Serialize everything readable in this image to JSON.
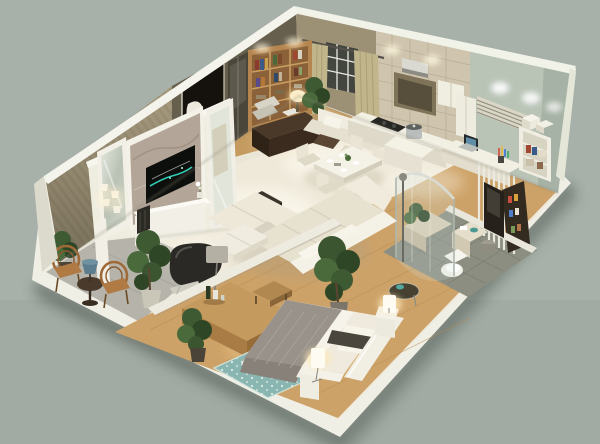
{
  "meta": {
    "type": "3d-render",
    "view": "isometric cutaway floor plan, viewed from above",
    "subject": "one-bedroom apartment interior with open living space"
  },
  "palette": {
    "background": "#a7b1a9",
    "shell_white": "#f0efe5",
    "tile_floor": "#efe9da",
    "wood_floor_bedroom": "#cda268",
    "wood_floor_study": "#c49a5f",
    "balcony_tile": "#b5b3aa",
    "bath_tile": "#8b8e80",
    "wall_stripe": "#a89c80",
    "wall_olive": "#665f4e",
    "wall_tan": "#9c9075",
    "wall_green": "#b9c3b6",
    "stone_wall": "#cfc5ae",
    "marble": "#b3a698",
    "partition_white": "#efece0",
    "sofa": "#e7e1d0",
    "blanket": "#98928a",
    "rug": "#8ab6b1",
    "curtain": "#c1b58b",
    "bookshelf_wood": "#b4854f",
    "desk_wood": "#4a3828",
    "tv_glow": "#35e0c5",
    "plant_green": "#3e5a32",
    "rattan": "#b07a45",
    "lamp_warm": "#fdf6e2"
  },
  "scene": {
    "rooms": [
      {
        "name": "living-room",
        "floor": "cream tile",
        "items": [
          "marble tv feature wall",
          "flatscreen tv",
          "white media console",
          "speaker",
          "framed mirror with sconce lamps",
          "tall dressing mirror",
          "l-shaped cream sectional sofa",
          "dark coffee table",
          "white ottoman table",
          "charcoal lounge chair with footrest",
          "grey floor lamp",
          "potted ficus tree"
        ]
      },
      {
        "name": "balcony",
        "floor": "grey marble tile",
        "items": [
          "two rattan armchairs",
          "round side table",
          "blue table lamp",
          "potted plant"
        ]
      },
      {
        "name": "study",
        "floor": "oak wood",
        "items": [
          "entry doorway",
          "striped wallpaper wall",
          "glass display cabinet",
          "wall bookshelf with books",
          "dark wood writing desk",
          "desk lamp",
          "upholstered chair",
          "hanging white robe",
          "potted plant"
        ]
      },
      {
        "name": "window-nook",
        "items": [
          "dark paned window",
          "tan curtains",
          "white loveseat",
          "small dark coffee table"
        ]
      },
      {
        "name": "kitchen",
        "floor": "cream tile",
        "items": [
          "stone tile backsplash",
          "cooker niche with hood",
          "upper cabinet",
          "tall cabinet",
          "white counter with cooktop",
          "island with steel pot"
        ]
      },
      {
        "name": "dining-area",
        "floor": "cream tile",
        "items": [
          "white dining table",
          "five white chairs",
          "place settings",
          "flower centerpiece"
        ]
      },
      {
        "name": "home-office",
        "floor": "oak wood",
        "items": [
          "white desk",
          "laptop",
          "pen cup with coloured pens",
          "white shelving unit",
          "storage boxes",
          "striped window blind",
          "slatted screen",
          "dark display rack"
        ]
      },
      {
        "name": "bathroom",
        "floor": "grey-green tile",
        "items": [
          "curved glass shower enclosure",
          "shower column",
          "white toilet",
          "vanity with towels",
          "dark framed mirror",
          "planted tub platform",
          "grey stool",
          "round glass side table with teal bowl"
        ]
      },
      {
        "name": "bedroom",
        "floor": "warm oak wood",
        "items": [
          "double bed",
          "grey textured blanket",
          "white sheets",
          "white pillows",
          "dark bolster pillow",
          "white headboard",
          "two white nightstands",
          "two glowing cylinder lamps",
          "teal patterned rug",
          "wooden sideboard",
          "wine bottles and decanter",
          "wooden bench",
          "potted trees"
        ]
      }
    ]
  }
}
